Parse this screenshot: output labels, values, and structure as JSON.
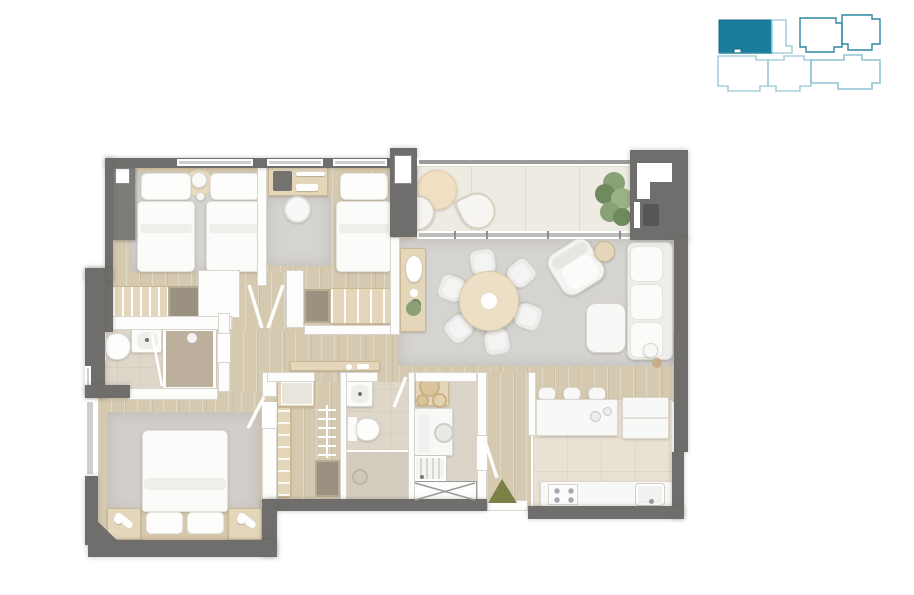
{
  "page": {
    "background": "#ffffff",
    "description": "3D-rendered top-view apartment floor plan with a building key plan in the top-right corner",
    "visible_text": "none"
  },
  "colors": {
    "wall-dark": "#6f6e6c",
    "wall-mid": "#9b9b99",
    "wall-white": "#fdfdfc",
    "wood": "#d5c9b0",
    "wood2": "#cfc3aa",
    "tile-balcony": "#eeebe2",
    "tile-kitchen": "#e9e1d3",
    "tile-bath": "#ddd6c9",
    "tile-shower": "#d4cdbf",
    "shower-dark": "#bcb09d",
    "rug": "#d6d4d0",
    "rug2": "#d2cfca",
    "wood-furn": "#e4d6bb",
    "wood-furn2": "#d9c8a8",
    "white-furn": "#f8f8f6",
    "furn-border": "#dcd8d0",
    "dark-box": "#9a9181",
    "plant": "#8aa178",
    "plant-dark": "#6e8a5e",
    "olive": "#7b8144",
    "teal": "#1b7d9c",
    "teal-mid": "#2e86a4",
    "teal-light": "#a7d0dc"
  },
  "key_plan": {
    "position": "top-right corner",
    "highlighted_unit": {
      "location": "top-left unit of building outline",
      "fill": "#1b7d9c"
    },
    "other_units": "unfilled outlines",
    "outline_colors": [
      "#a7d0dc",
      "#2e86a4"
    ]
  },
  "floor_plan": {
    "entrance_marker": {
      "shape": "upward-pointing triangle",
      "color": "#7b8144",
      "location": "at entry door, bottom center-right"
    },
    "rooms": [
      {
        "name": "bedroom-1",
        "position": "top-left",
        "furniture": [
          "twin bed",
          "twin bed",
          "round rug with stool",
          "gray wardrobe",
          "closet with hangers",
          "dresser",
          "area rug"
        ]
      },
      {
        "name": "bedroom-2",
        "position": "top-middle",
        "furniture": [
          "desk with accessories",
          "desk chair",
          "single bed",
          "area rug",
          "closet with shelves"
        ]
      },
      {
        "name": "balcony",
        "position": "top-right",
        "furniture": [
          "round table",
          "two lounge chairs",
          "potted plant"
        ]
      },
      {
        "name": "living-dining",
        "position": "center-right",
        "furniture": [
          "sideboard with decor and plant",
          "round dining table",
          "six dining chairs",
          "armchair",
          "round side table",
          "three-seat sofa",
          "ottoman",
          "floor lamp",
          "large area rug"
        ]
      },
      {
        "name": "kitchen",
        "position": "bottom-right",
        "furniture": [
          "island with sink and three stools",
          "refrigerator",
          "counter with cooktop and sink"
        ]
      },
      {
        "name": "laundry",
        "position": "bottom-center-right",
        "furniture": [
          "counter with baskets",
          "washing machine",
          "utility sink",
          "crossed storage box"
        ]
      },
      {
        "name": "bathroom-2",
        "position": "bottom-center",
        "furniture": [
          "washbasin",
          "toilet",
          "walk-in shower with drain"
        ]
      },
      {
        "name": "walk-in-closet",
        "position": "bottom-center-left",
        "furniture": [
          "shelf unit",
          "hanging rod with hangers",
          "drawer box"
        ]
      },
      {
        "name": "master-bathroom",
        "position": "middle-left",
        "furniture": [
          "toilet",
          "washbasin",
          "shower with glass door"
        ]
      },
      {
        "name": "master-bedroom",
        "position": "bottom-left",
        "furniture": [
          "double bed",
          "two nightstands with lamps",
          "area rug"
        ]
      },
      {
        "name": "hallway",
        "position": "center",
        "furniture": [
          "slim console"
        ]
      }
    ]
  }
}
